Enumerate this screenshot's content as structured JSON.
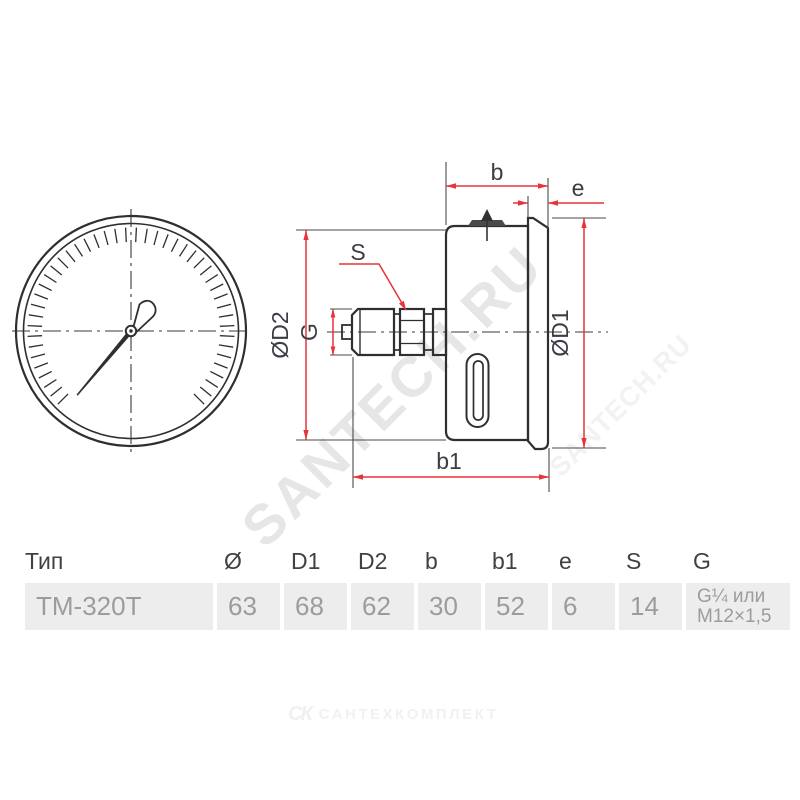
{
  "watermark": {
    "primary": "SANTECH.RU",
    "secondary": "SANTECH.RU"
  },
  "drawing": {
    "labels": {
      "b": "b",
      "e": "e",
      "b1": "b1",
      "s": "S",
      "g": "G",
      "d1": "ØD1",
      "d2": "ØD2"
    }
  },
  "table": {
    "headers": [
      "Тип",
      "Ø",
      "D1",
      "D2",
      "b",
      "b1",
      "e",
      "S",
      "G"
    ],
    "row": {
      "tip": "ТМ-320Т",
      "o": "63",
      "d1": "68",
      "d2": "62",
      "b": "30",
      "b1": "52",
      "e": "6",
      "s": "14",
      "g1": "G¼ или",
      "g2": "M12×1,5"
    }
  },
  "footer": {
    "logo_icon": "СК",
    "logo_text": "САНТЕХКОМПЛЕКТ"
  },
  "colors": {
    "dimension_red": "#e5343a",
    "outline_dark": "#2f2f2f",
    "thin_line": "#4a4a4a",
    "table_band": "#ededed",
    "data_text": "#9c9c9c",
    "watermark": "#e6e6e6"
  }
}
